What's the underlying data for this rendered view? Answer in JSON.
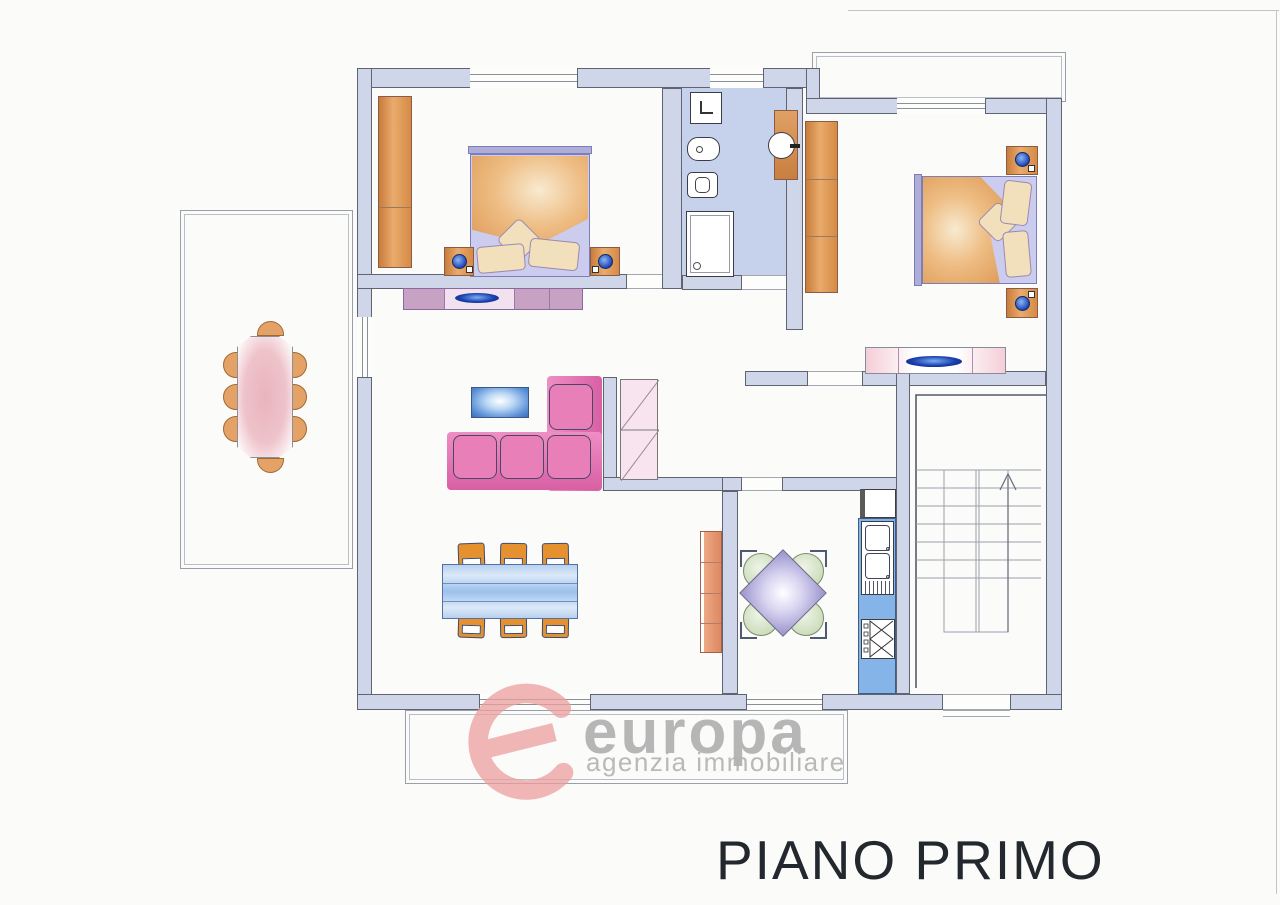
{
  "title": {
    "floor_label": "PIANO PRIMO"
  },
  "logo": {
    "wordmark": "europa",
    "tagline": "agenzia immobiliare"
  },
  "colors": {
    "wall-fill": "#cfd6ea",
    "wall-line": "#5f6470",
    "bath-floor": "#c6d1ec",
    "wood-orange": "#dd9355",
    "mauve": "#c7a2c5",
    "sofa-pink": "#e97fb9",
    "sofa-base": "#de6cab",
    "blue-table": "#a9c8ef",
    "kitchen-blue": "#85b5e8",
    "chair-green": "#cbdcba",
    "chair-orange": "#e5912f",
    "terrace-pink": "#e7aeb9",
    "kitchen-table-purple": "#9a92cc",
    "lamp-blue": "#2244bb",
    "logo-red": "#ec9f9f",
    "logo-gray": "#a6a6a6",
    "title-color": "#23272e",
    "thin-line": "#8a90a0"
  }
}
